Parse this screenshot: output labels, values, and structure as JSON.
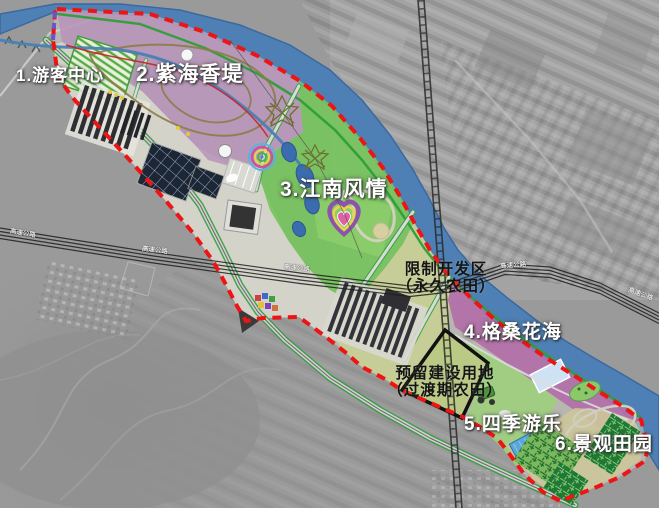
{
  "map": {
    "zones": [
      {
        "label": "1.游客中心"
      },
      {
        "label": "2.紫海香堤"
      },
      {
        "label": "3.江南风情"
      },
      {
        "label": "4.格桑花海"
      },
      {
        "label": "5.四季游乐"
      },
      {
        "label": "6.景观田园"
      }
    ],
    "restricted_area": {
      "line1": "限制开发区",
      "line2": "（永久农田）"
    },
    "reserved_area": {
      "line1": "预留建设用地",
      "line2": "（过渡期农田）"
    },
    "road_label": "高速公路",
    "colors": {
      "river": "#4e80b5",
      "boundary": "#ee1414",
      "zone2_purple": "#b791ba",
      "zone3_green": "#6fc355",
      "zone4_pink": "#b168a8",
      "zone5_green": "#9ed17b",
      "zone6_khaki": "#cdc69b",
      "farmland_olive": "#c9cf94",
      "reserved_fill": "#b9ca82",
      "maze_green": "#1e7a33",
      "road_edge_green": "#2f9e38"
    }
  }
}
